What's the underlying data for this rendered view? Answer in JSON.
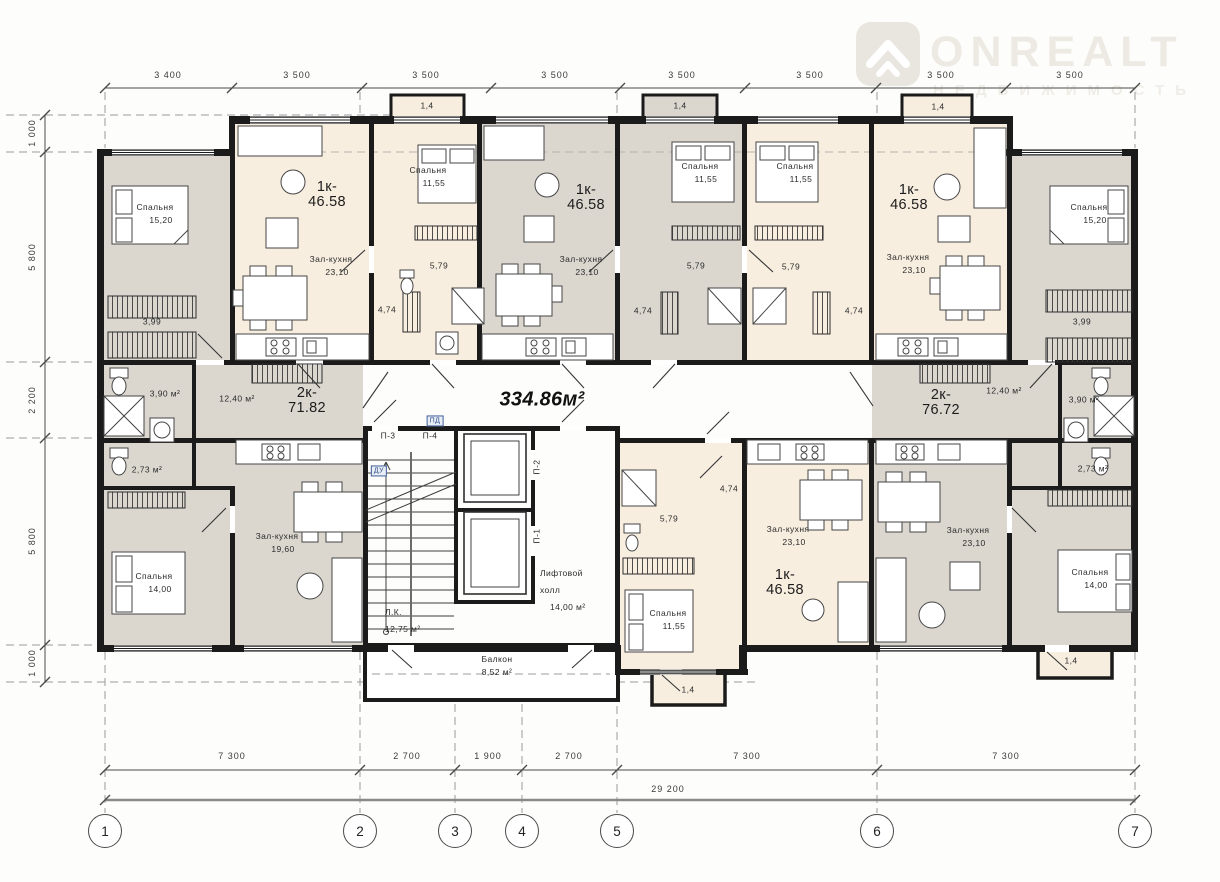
{
  "logo": {
    "brand": "ONREALT",
    "subtitle": "НЕДВИЖИМОСТЬ",
    "icon": "house-chevron-icon"
  },
  "plan": {
    "total_area": "334.86м²"
  },
  "dims": {
    "top": [
      "3 400",
      "3 500",
      "3 500",
      "3 500",
      "3 500",
      "3 500",
      "3 500",
      "3 500"
    ],
    "left": [
      "1 000",
      "5 800",
      "2 200",
      "5 800",
      "1 000"
    ],
    "bottom": [
      "7 300",
      "2 700",
      "1 900",
      "2 700",
      "7 300",
      "7 300"
    ],
    "overall": "29 200"
  },
  "axes": [
    "1",
    "2",
    "3",
    "4",
    "5",
    "6",
    "7"
  ],
  "apartments": [
    {
      "type": "1к-",
      "area": "46.58"
    },
    {
      "type": "1к-",
      "area": "46.58"
    },
    {
      "type": "1к-",
      "area": "46.58"
    },
    {
      "type": "2к-",
      "area": "71.82"
    },
    {
      "type": "2к-",
      "area": "76.72"
    },
    {
      "type": "1к-",
      "area": "46.58"
    }
  ],
  "bedrooms": [
    {
      "name": "Спальня",
      "area": "15,20"
    },
    {
      "name": "Спальня",
      "area": "11,55"
    },
    {
      "name": "Спальня",
      "area": "11,55"
    },
    {
      "name": "Спальня",
      "area": "11,55"
    },
    {
      "name": "Спальня",
      "area": "15,20"
    },
    {
      "name": "Спальня",
      "area": "14,00"
    },
    {
      "name": "Спальня",
      "area": "11,55"
    },
    {
      "name": "Спальня",
      "area": "14,00"
    }
  ],
  "living_rooms": [
    {
      "name": "Зал-кухня",
      "area": "23,10"
    },
    {
      "name": "Зал-кухня",
      "area": "23,10"
    },
    {
      "name": "Зал-кухня",
      "area": "23,10"
    },
    {
      "name": "Зал-кухня",
      "area": "19,60"
    },
    {
      "name": "Зал-кухня",
      "area": "23,10"
    },
    {
      "name": "Зал-кухня",
      "area": "23,10"
    }
  ],
  "small_rooms": {
    "wardrobe_tl": "3,99",
    "wardrobe_tr": "3,99",
    "hall_b": "5,79",
    "hall_c": "5,79",
    "hall_d": "5,79",
    "hall_f": "5,79",
    "bath_b": "4,74",
    "bath_c": "4,74",
    "bath_d": "4,74",
    "bath_f": "4,74",
    "wc_left": "3,90 м²",
    "wc_right": "3,90 м²",
    "bath_left": "2,73 м²",
    "bath_right": "2,73 м²",
    "hall_left": "12,40 м²",
    "hall_right": "12,40 м²"
  },
  "core": {
    "stair": "Л.К.",
    "stair_area": "12,75 м²",
    "lift_line1": "Лифтовой",
    "lift_line2": "холл",
    "lift_area": "14,00 м²",
    "balcony": "Балкон",
    "balcony_area": "8,52 м²",
    "p1": "П-1",
    "p2": "П-2",
    "p3": "П-3",
    "p4": "П-4",
    "pd": "ПД",
    "du": "ДУ"
  },
  "balconies": [
    "1,4",
    "1,4",
    "1,4",
    "1,4",
    "1,4"
  ],
  "colors": {
    "cream": "#f8eee0",
    "gray": "#dbd7cf",
    "wall": "#1b1b1b",
    "dim_line": "#4b4b4b",
    "watermark": "#edeae3"
  }
}
